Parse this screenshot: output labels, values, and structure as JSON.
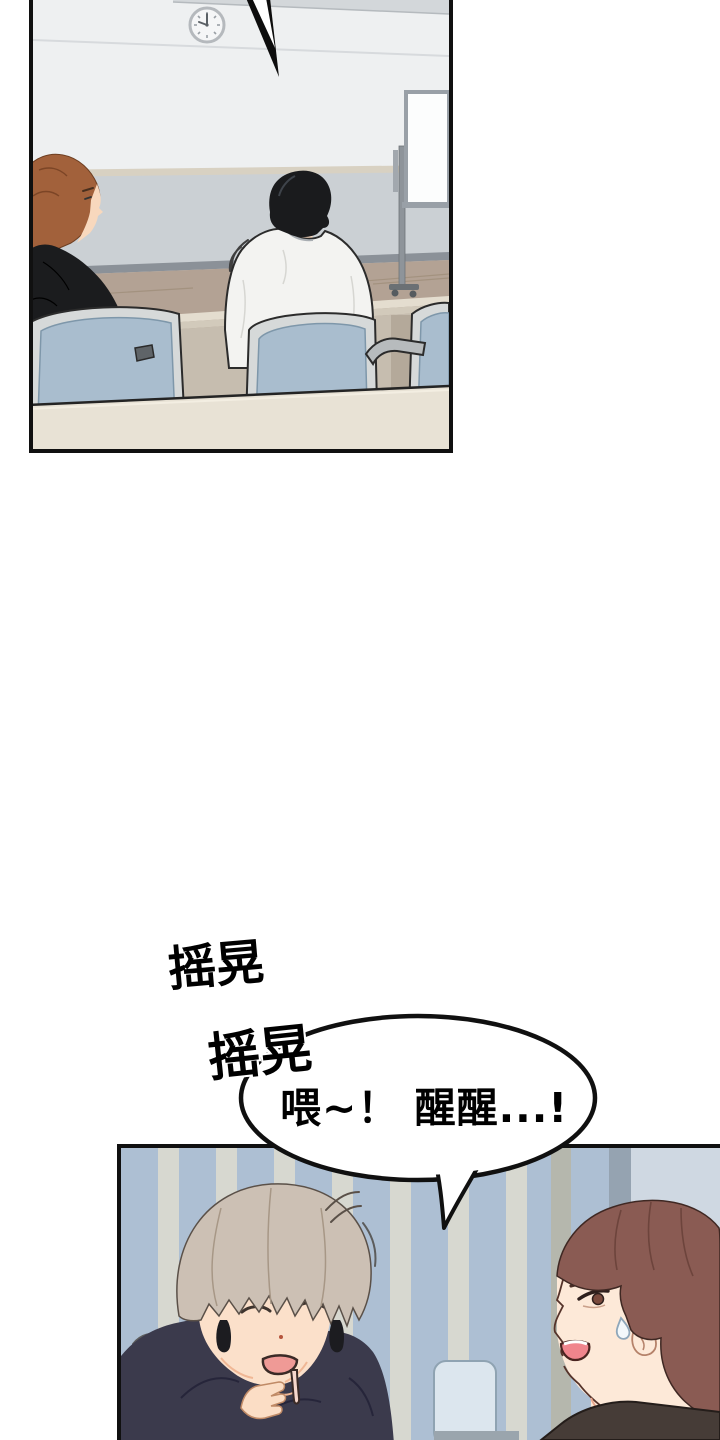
{
  "comic": {
    "sfx": [
      {
        "text": "摇晃"
      },
      {
        "text": "摇晃"
      }
    ],
    "speech": {
      "text": "喂~！ 醒醒...!"
    }
  },
  "colors": {
    "panel_border": "#101010",
    "page_bg": "#ffffff",
    "ceiling": "#d3d7da",
    "wall_upper": "#eef0f1",
    "wall_lower": "#cbd0d4",
    "rail": "#d8d1c2",
    "baseboard": "#8b9198",
    "floor_wood": "#b3a294",
    "whiteboard_face": "#fcfdfd",
    "whiteboard_frame": "#99a0a7",
    "desk_top": "#e4ddcf",
    "desk_front": "#d2cabb",
    "desk_under": "#c6bdaf",
    "desk_fore": "#e8e2d5",
    "chair_mesh": "#a9bdce",
    "chair_frame": "#d6d9d9",
    "hair_brown": "#a2613b",
    "hair_black": "#1a1b1d",
    "skin": "#f8d8bd",
    "jacket_black": "#1b1c1e",
    "shirt_white": "#f3f3f1",
    "stripe_base": "#c7d2de",
    "stripe_blue": "#adbfd3",
    "stripe_cream": "#d7d8d0",
    "stripe_pale": "#cfd8e2",
    "stripe_tan": "#b5b7ad",
    "stripe_slate": "#95a3b1",
    "sleeper_hair": "#ccc0b4",
    "sleeper_skin": "#fbe0ca",
    "hoodie": "#3b3a4c",
    "hood_inner": "#2e2d3f",
    "friend_hair": "#8a5b53",
    "friend_skin": "#fde9d8",
    "friend_shirt": "#463c37",
    "mouth_pink": "#ef9a96",
    "friend_mouth": "#f0858d",
    "bubble_fill": "#ffffff"
  }
}
